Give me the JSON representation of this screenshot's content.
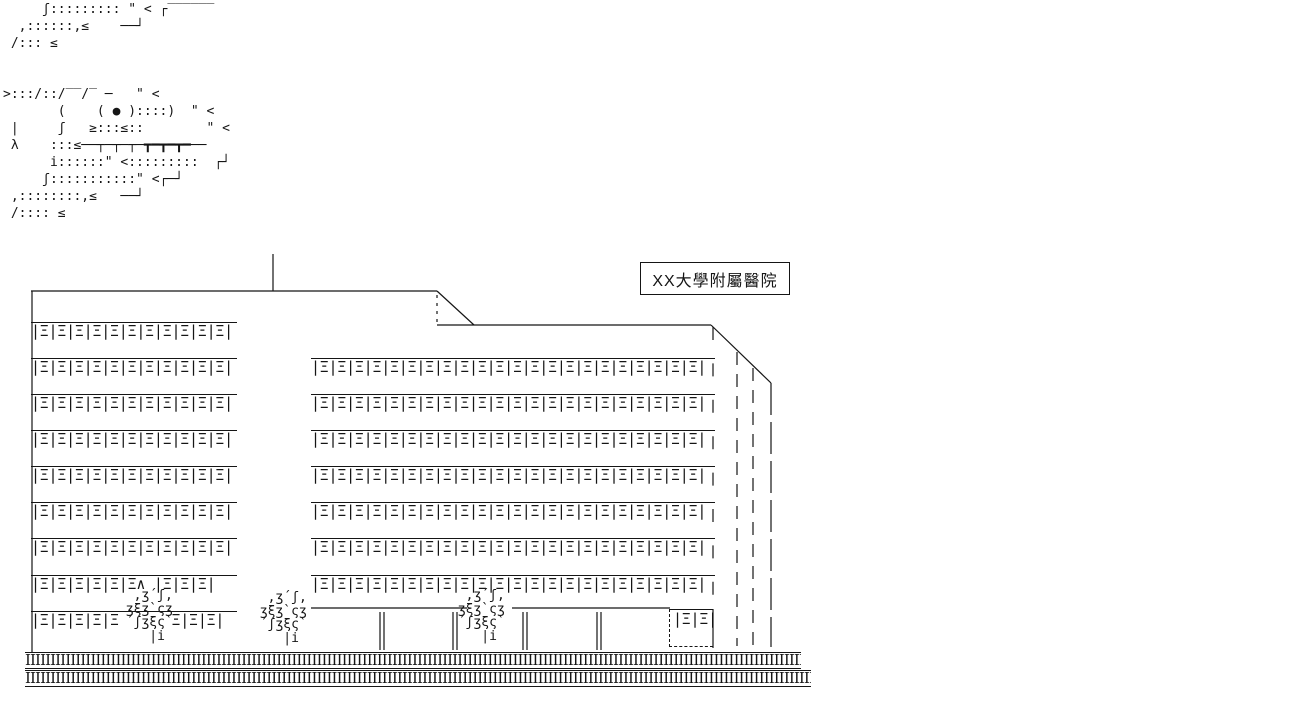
{
  "scene": {
    "background": "#ffffff",
    "ink": "#151515"
  },
  "creature": {
    "lines": [
      "     ʃ::::::::: \" < ┌‾‾‾‾‾‾",
      "  ,::::::,≤    ──┘",
      " /::: ≤",
      "",
      "",
      ">:::/::/‾‾/‾ ─   \" <",
      "       (    ( ● )::::)  \" <",
      " |     ʃ   ≥:::≤::        \" <",
      " λ    :::≤──┬─┬─┬─┳━┳━┳━──",
      "      i::::::\" <:::::::::  ┌┘",
      "     ʃ:::::::::::\" <┌─┘",
      " ,::::::::,≤   ──┘",
      " /:::: ≤"
    ]
  },
  "hospital": {
    "label": "XX大學附屬醫院",
    "left_tower": {
      "window_row": "|Ξ|Ξ|Ξ|Ξ|Ξ|Ξ|Ξ|Ξ|Ξ|Ξ|Ξ|",
      "window_row_tree_top": "|Ξ|Ξ|Ξ|Ξ|Ξ|Ξ∧ |Ξ|Ξ|Ξ|",
      "window_row_ground": "|Ξ|Ξ|Ξ|Ξ|Ξ      Ξ|Ξ|Ξ|"
    },
    "right_wing": {
      "window_row": "|Ξ|Ξ|Ξ|Ξ|Ξ|Ξ|Ξ|Ξ|Ξ|Ξ|Ξ|Ξ|Ξ|Ξ|Ξ|Ξ|Ξ|Ξ|Ξ|Ξ|Ξ|Ξ|"
    },
    "kiosk_windows": "|Ξ|Ξ|",
    "tree": {
      "lines": [
        "  ,ʒ´ʃ,",
        " ʒξʒ`ςʒ",
        " ´ʃʒξς`",
        "    |i"
      ]
    },
    "ground_hatch": "IIIIIIIIIIIIIIIIIIIIIIIIIIIIIIIIIIIIIIIIIIIIIIIIIIIIIIIIIIIIIIIIIIIIIIIIIIIIIIIIIIIIIIIIIIIIIIIIIIIIIIIIIIIIIIIIIIIIIIIIIIIIIIIIIIIIIIIIIIIIIIIIIIIIIIIIIIIIIIIIIIIIIIIIIIIIIIIIIIIIIIIIIIIIIIIIIIIIII"
  }
}
